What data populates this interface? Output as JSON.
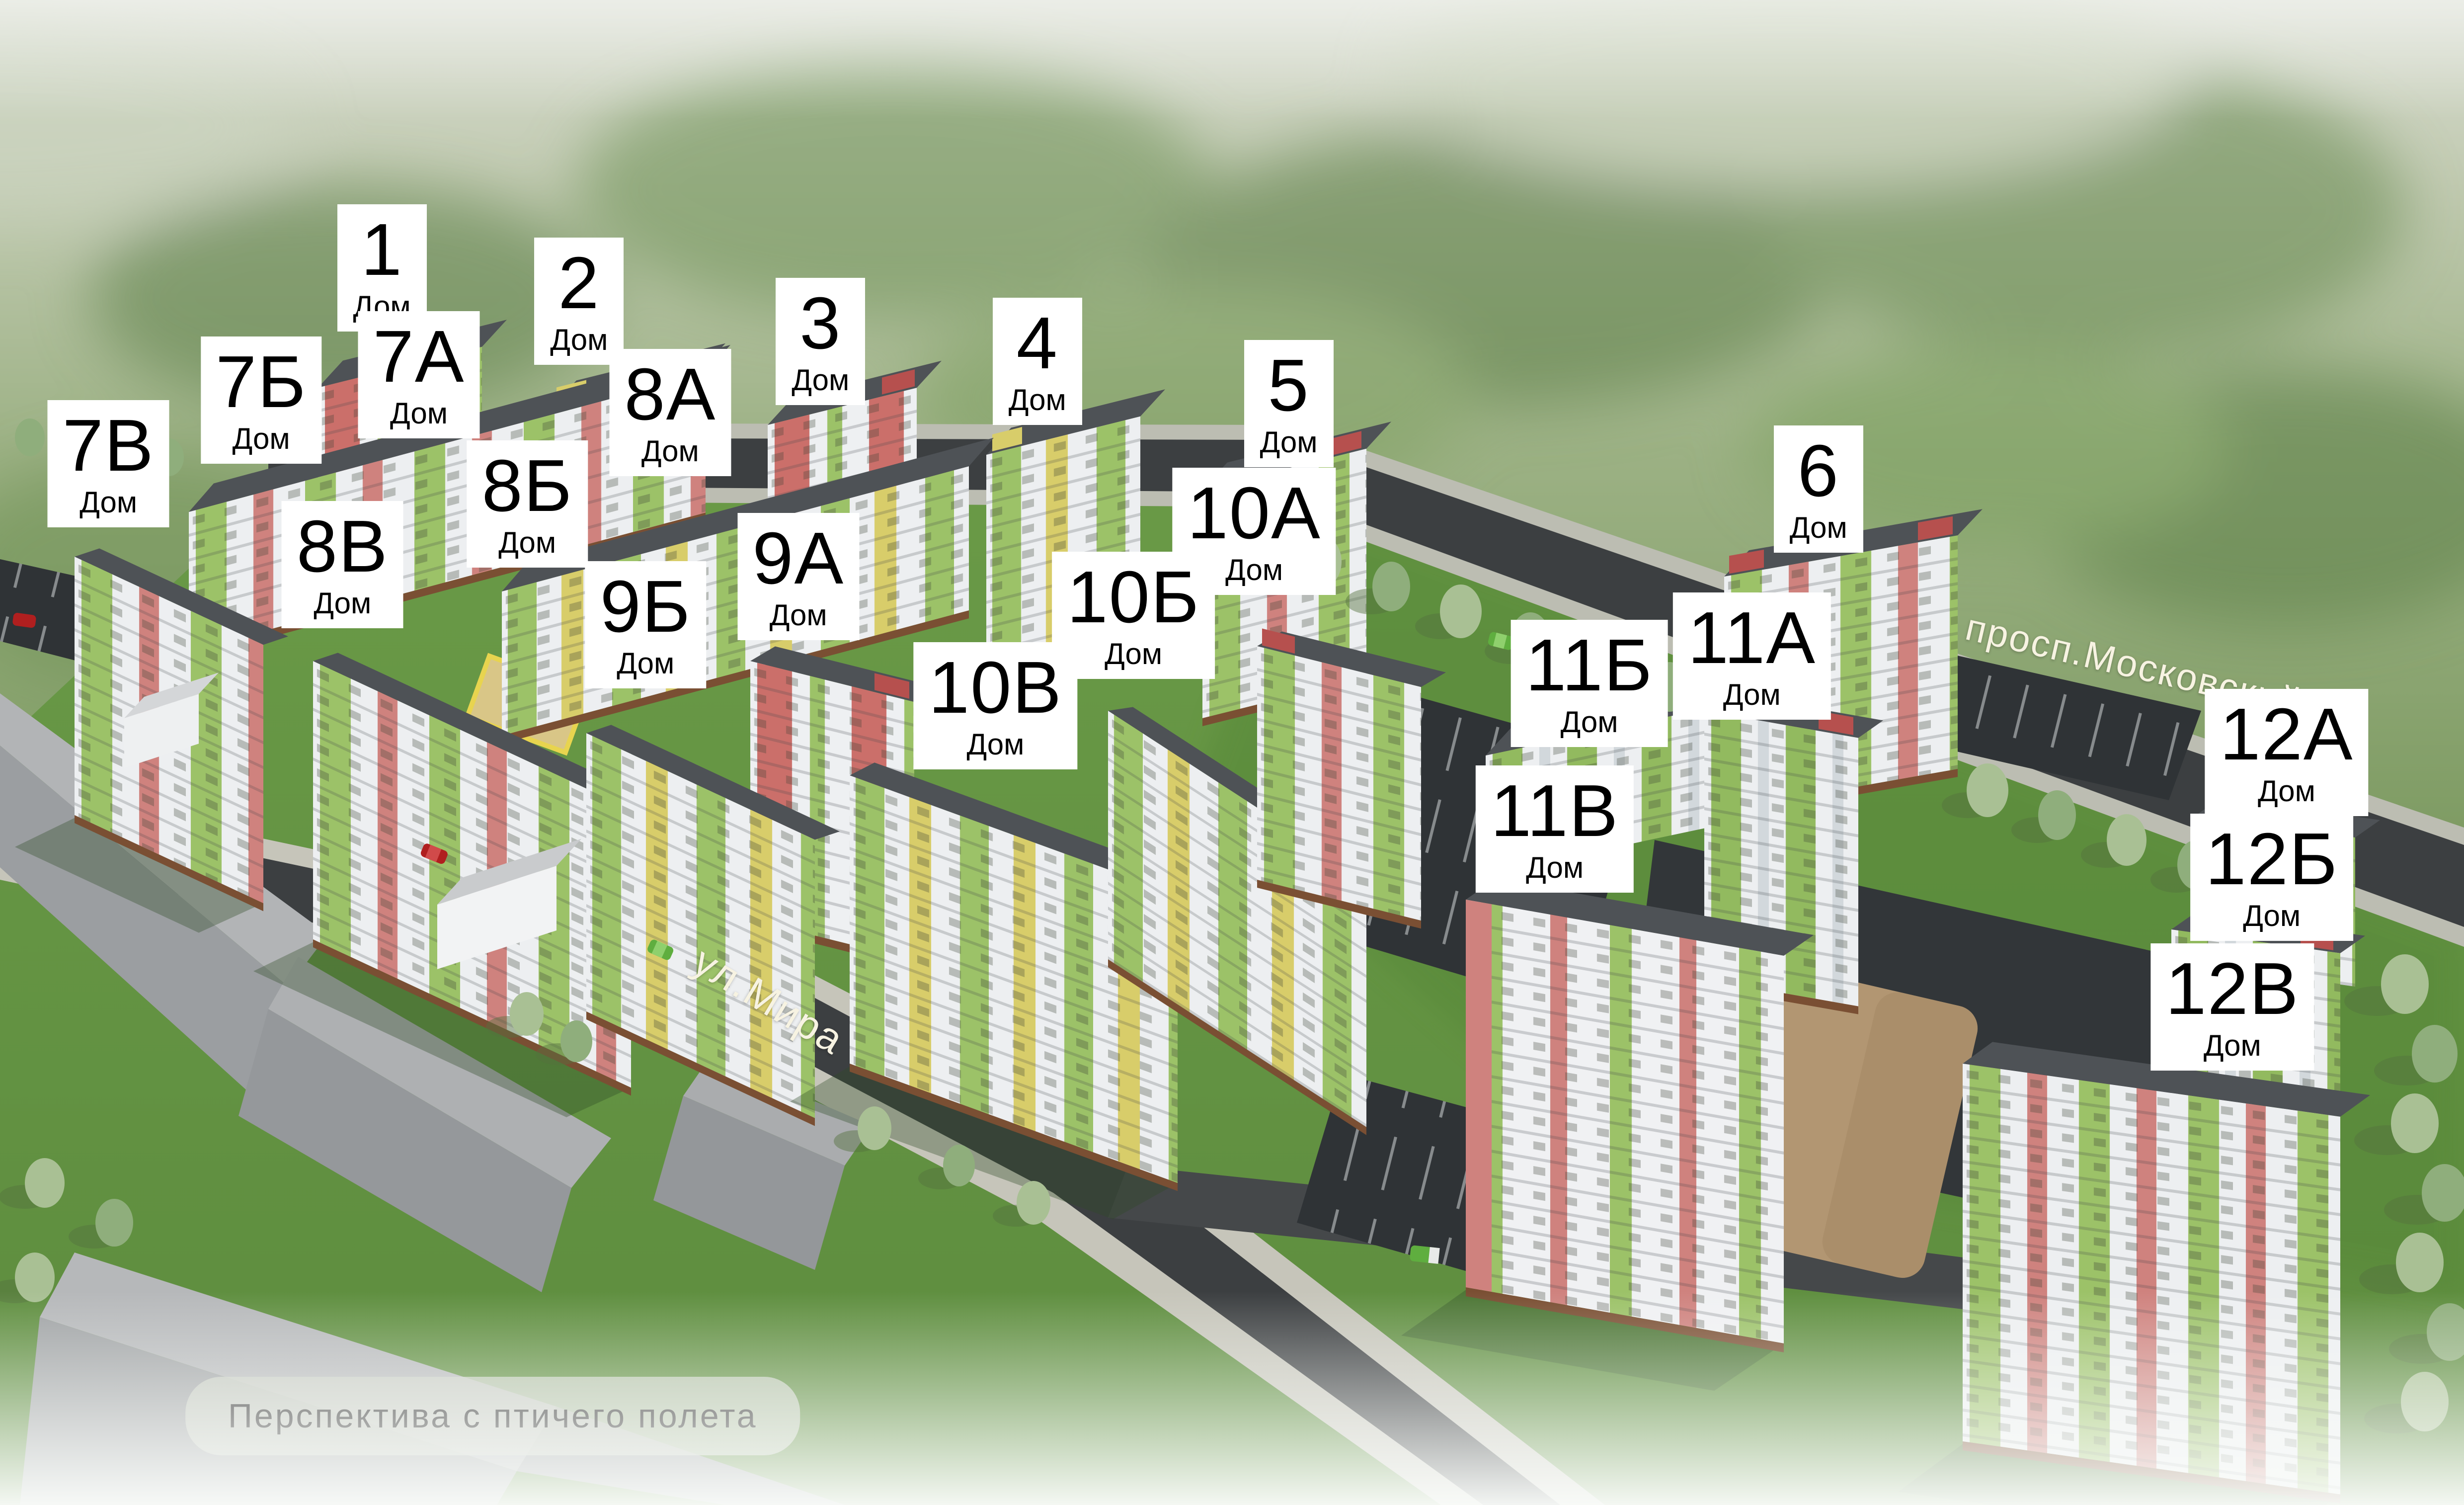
{
  "caption": {
    "text": "Перспектива с птичего полета",
    "x": 20.0,
    "y": 94.1
  },
  "streets": [
    {
      "label": "ул.Мира",
      "x": 31.2,
      "y": 66.5,
      "rotate": 31
    },
    {
      "label": "просп.Московский",
      "x": 86.6,
      "y": 44.2,
      "rotate": 13
    }
  ],
  "buildings": [
    {
      "number": "1",
      "sub": "Дом",
      "x": 15.5,
      "y": 17.8
    },
    {
      "number": "2",
      "sub": "Дом",
      "x": 23.5,
      "y": 20.0
    },
    {
      "number": "3",
      "sub": "Дом",
      "x": 33.3,
      "y": 22.7
    },
    {
      "number": "4",
      "sub": "Дом",
      "x": 42.1,
      "y": 24.0
    },
    {
      "number": "5",
      "sub": "Дом",
      "x": 52.3,
      "y": 26.8
    },
    {
      "number": "6",
      "sub": "Дом",
      "x": 73.8,
      "y": 32.5
    },
    {
      "number": "7А",
      "sub": "Дом",
      "x": 17.0,
      "y": 24.9
    },
    {
      "number": "7Б",
      "sub": "Дом",
      "x": 10.6,
      "y": 26.6
    },
    {
      "number": "7В",
      "sub": "Дом",
      "x": 4.4,
      "y": 30.8
    },
    {
      "number": "8А",
      "sub": "Дом",
      "x": 27.2,
      "y": 27.4
    },
    {
      "number": "8Б",
      "sub": "Дом",
      "x": 21.4,
      "y": 33.5
    },
    {
      "number": "8В",
      "sub": "Дом",
      "x": 13.9,
      "y": 37.5
    },
    {
      "number": "9А",
      "sub": "Дом",
      "x": 32.4,
      "y": 38.3
    },
    {
      "number": "9Б",
      "sub": "Дом",
      "x": 26.2,
      "y": 41.5
    },
    {
      "number": "10А",
      "sub": "Дом",
      "x": 50.9,
      "y": 35.3
    },
    {
      "number": "10Б",
      "sub": "Дом",
      "x": 46.0,
      "y": 40.9
    },
    {
      "number": "10В",
      "sub": "Дом",
      "x": 40.4,
      "y": 46.9
    },
    {
      "number": "11А",
      "sub": "Дом",
      "x": 71.1,
      "y": 43.6
    },
    {
      "number": "11Б",
      "sub": "Дом",
      "x": 64.5,
      "y": 45.4
    },
    {
      "number": "11В",
      "sub": "Дом",
      "x": 63.1,
      "y": 55.1
    },
    {
      "number": "12А",
      "sub": "Дом",
      "x": 92.8,
      "y": 50.0
    },
    {
      "number": "12Б",
      "sub": "Дом",
      "x": 92.2,
      "y": 58.3
    },
    {
      "number": "12В",
      "sub": "Дом",
      "x": 90.6,
      "y": 66.9
    }
  ],
  "colors": {
    "grass": "#659544",
    "road": "#3c3f41",
    "facade_green": "#92ba5f",
    "facade_yellow": "#d8cd6a",
    "facade_pink": "#cf827e",
    "roof": "#4e5256",
    "label_bg": "#ffffff",
    "label_text": "#000000",
    "street_text": "#f7f3e2"
  }
}
